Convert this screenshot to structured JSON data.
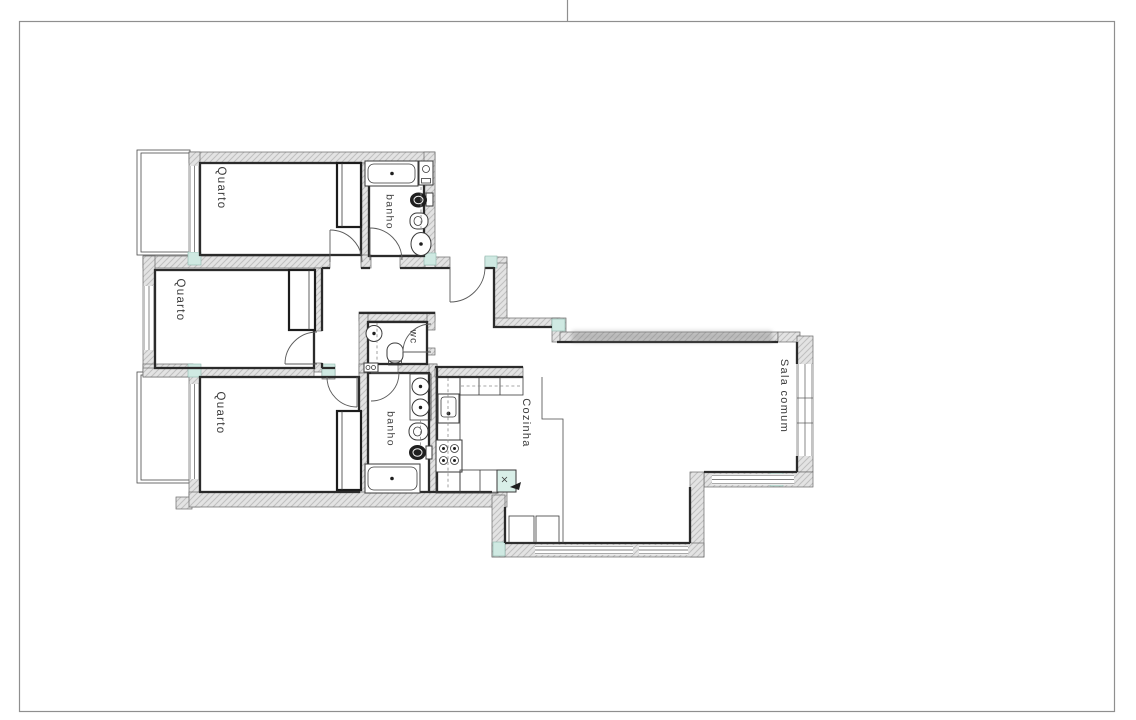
{
  "plan": {
    "rooms": [
      {
        "id": "quarto-1",
        "label": "Quarto"
      },
      {
        "id": "quarto-2",
        "label": "Quarto"
      },
      {
        "id": "quarto-3",
        "label": "Quarto"
      },
      {
        "id": "banho-1",
        "label": "banho"
      },
      {
        "id": "wc",
        "label": "wc"
      },
      {
        "id": "banho-2",
        "label": "banho"
      },
      {
        "id": "cozinha",
        "label": "Cozinha"
      },
      {
        "id": "sala-comum",
        "label": "Sala comum"
      }
    ],
    "colors": {
      "background": "#ffffff",
      "wall_fill": "#e3e3e3",
      "wall_hatch": "#bfbfbf",
      "room_outline": "#2b2b2b",
      "accent_pillar": "#cfe9e2",
      "page_frame": "#8f8f8f"
    }
  }
}
